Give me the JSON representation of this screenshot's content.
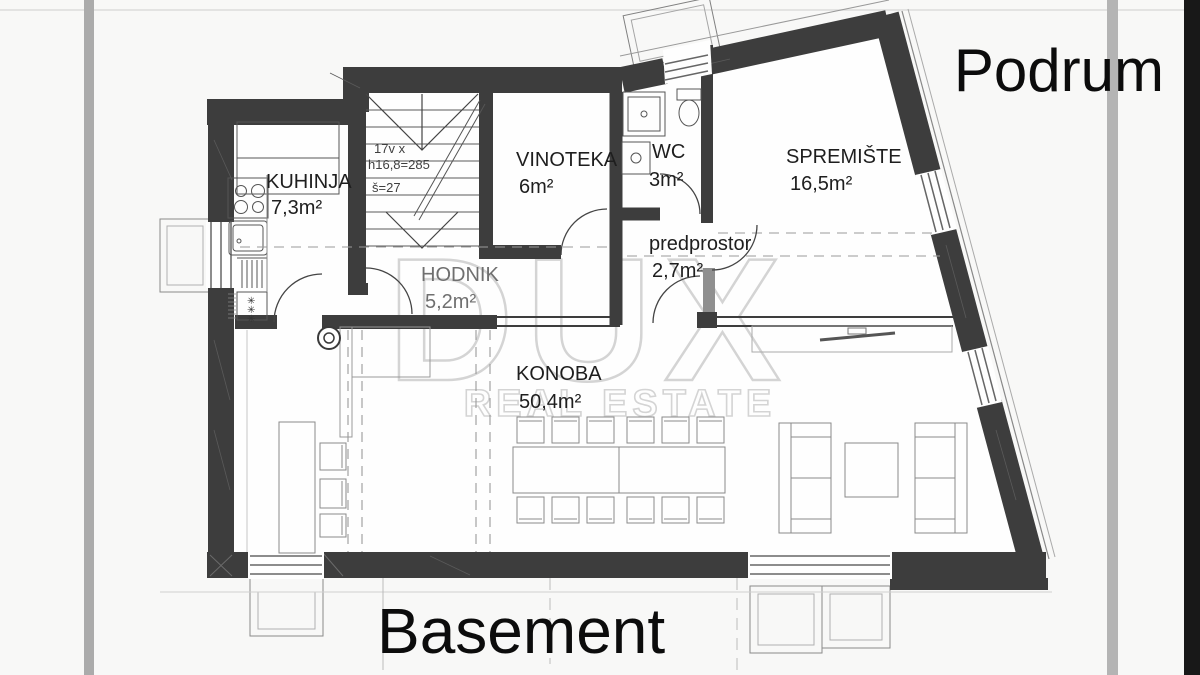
{
  "title_top_right": "Podrum",
  "title_bottom": "Basement",
  "watermark": {
    "brand": "DUX",
    "tagline": "REAL ESTATE"
  },
  "rooms": {
    "kuhinja": {
      "name": "KUHINJA",
      "area": "7,3m²"
    },
    "vinoteka": {
      "name": "VINOTEKA",
      "area": "6m²"
    },
    "wc": {
      "name": "WC",
      "area": "3m²"
    },
    "spremiste": {
      "name": "SPREMIŠTE",
      "area": "16,5m²"
    },
    "predprostor": {
      "name": "predprostor",
      "area": "2,7m²"
    },
    "hodnik": {
      "name": "HODNIK",
      "area": "5,2m²"
    },
    "konoba": {
      "name": "KONOBA",
      "area": "50,4m²"
    }
  },
  "stairs_note": {
    "line1": "17v x",
    "line2": "h16,8=285",
    "line3": "š=27"
  },
  "symbols": {
    "boiler_mark": "✳"
  },
  "colors": {
    "wall": "#3d3d3d",
    "stripe": "#b0b0b0",
    "edge_bar": "#181818",
    "line": "#555555"
  }
}
